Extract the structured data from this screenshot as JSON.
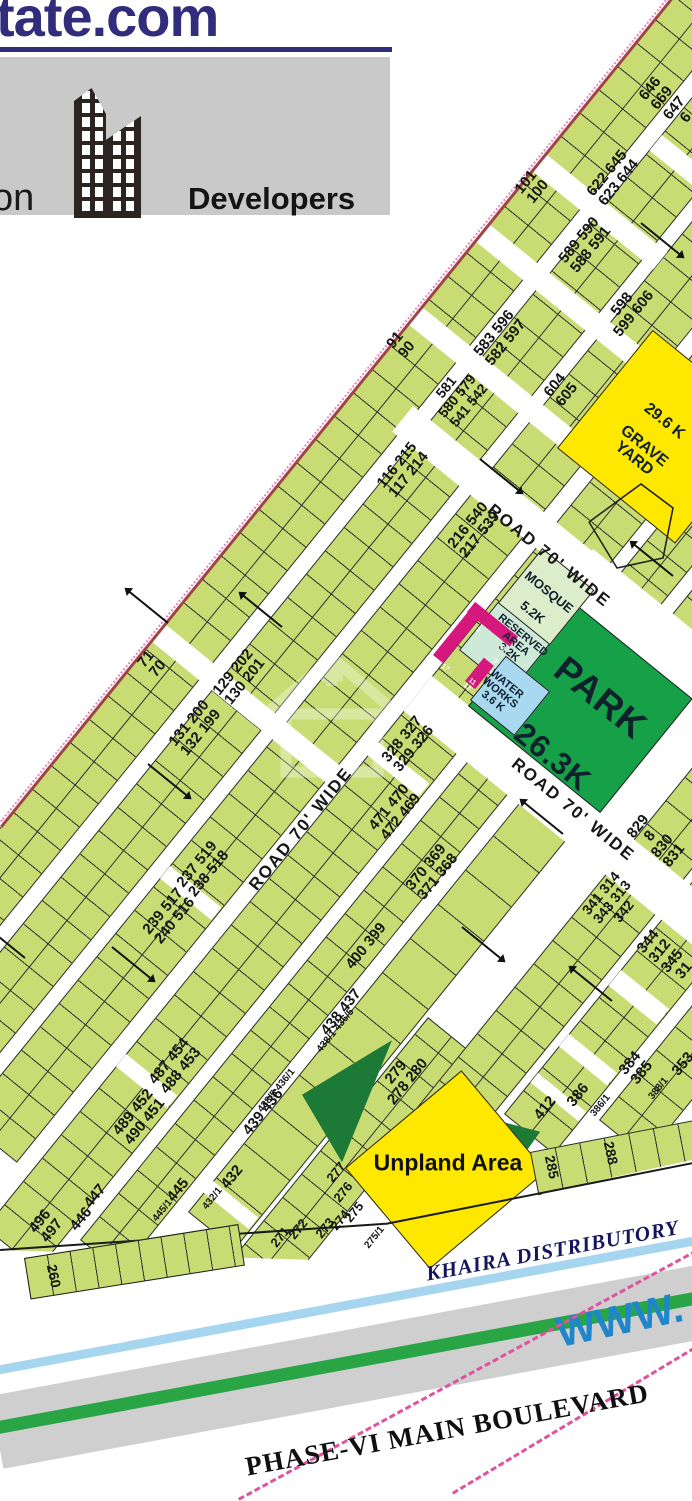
{
  "header": {
    "site_fragment": "tate.com",
    "partial_word": "on",
    "developers_label": "Developers"
  },
  "map": {
    "road_labels": [
      {
        "text": "ROAD 70' WIDE",
        "x": 549,
        "y": 556,
        "rot": 39
      },
      {
        "text": "ROAD 70' WIDE",
        "x": 301,
        "y": 829,
        "rot": -51
      },
      {
        "text": "ROAD 70' WIDE",
        "x": 573,
        "y": 810,
        "rot": 39
      }
    ],
    "areas": {
      "park": {
        "name": "PARK",
        "size": "26.3K"
      },
      "mosque": {
        "name": "MOSQUE",
        "size": "5.2K"
      },
      "reserved": {
        "name": "RESERVED AREA",
        "size": "3.2K"
      },
      "water_works": {
        "name": "WATER WORKS",
        "size": "3.6 K"
      },
      "grave_yard": {
        "size": "29.6 K",
        "name": "GRAVE YARD"
      },
      "unplanned": {
        "name": "Unpland Area"
      }
    },
    "plot_labels": [
      {
        "t": "101\n100",
        "x": 532,
        "y": 187
      },
      {
        "t": "91\n90",
        "x": 401,
        "y": 345
      },
      {
        "t": "71\n70",
        "x": 152,
        "y": 664
      },
      {
        "t": "646 669\n647 6",
        "x": 668,
        "y": 103
      },
      {
        "t": "622 645\n623 644",
        "x": 613,
        "y": 178
      },
      {
        "t": "589 590\n588 591",
        "x": 585,
        "y": 245
      },
      {
        "t": "583 596\n582 597",
        "x": 500,
        "y": 338
      },
      {
        "t": "598\n599 606",
        "x": 628,
        "y": 309
      },
      {
        "t": "604\n605",
        "x": 561,
        "y": 390
      },
      {
        "t": "581\n580 579\n541 542",
        "x": 457,
        "y": 396,
        "s": 14
      },
      {
        "t": "116 215\n117 214",
        "x": 403,
        "y": 470
      },
      {
        "t": "216 540\n217 539",
        "x": 474,
        "y": 530
      },
      {
        "t": "129 202\n130 201",
        "x": 239,
        "y": 677
      },
      {
        "t": "131 200\n132 199",
        "x": 195,
        "y": 728
      },
      {
        "t": "237 519\n238 518",
        "x": 203,
        "y": 869
      },
      {
        "t": "239 517\n240 516",
        "x": 169,
        "y": 916
      },
      {
        "t": "328 327\n329 326",
        "x": 408,
        "y": 744
      },
      {
        "t": "471 470\n472 469",
        "x": 395,
        "y": 812
      },
      {
        "t": "370 369\n371 368",
        "x": 432,
        "y": 872
      },
      {
        "t": "400 399",
        "x": 366,
        "y": 946
      },
      {
        "t": "487 454\n488 453",
        "x": 175,
        "y": 1066
      },
      {
        "t": "489 452\n490 451",
        "x": 139,
        "y": 1117
      },
      {
        "t": "438 437",
        "x": 341,
        "y": 1012
      },
      {
        "t": "438/1 436/5",
        "x": 336,
        "y": 1031,
        "s": 10
      },
      {
        "t": "438/5 436/1",
        "x": 277,
        "y": 1091,
        "s": 10
      },
      {
        "t": "439 436",
        "x": 263,
        "y": 1112
      },
      {
        "t": "445",
        "x": 178,
        "y": 1190
      },
      {
        "t": "445/1",
        "x": 163,
        "y": 1211,
        "s": 10
      },
      {
        "t": "432",
        "x": 232,
        "y": 1177
      },
      {
        "t": "432/1",
        "x": 213,
        "y": 1199,
        "s": 10
      },
      {
        "t": "447",
        "x": 95,
        "y": 1196
      },
      {
        "t": "446",
        "x": 81,
        "y": 1219
      },
      {
        "t": "496\n497",
        "x": 46,
        "y": 1226
      },
      {
        "t": "279\n278 280",
        "x": 402,
        "y": 1077
      },
      {
        "t": "277",
        "x": 336,
        "y": 1172,
        "s": 13
      },
      {
        "t": "276",
        "x": 343,
        "y": 1192,
        "s": 13
      },
      {
        "t": "275",
        "x": 354,
        "y": 1212,
        "s": 13
      },
      {
        "t": "274",
        "x": 340,
        "y": 1220,
        "s": 13
      },
      {
        "t": "273",
        "x": 325,
        "y": 1228,
        "s": 13
      },
      {
        "t": "272",
        "x": 298,
        "y": 1229,
        "s": 13
      },
      {
        "t": "271",
        "x": 280,
        "y": 1237,
        "s": 13
      },
      {
        "t": "275/1",
        "x": 375,
        "y": 1238,
        "s": 10
      },
      {
        "t": "341 314\n343 313\n342",
        "x": 612,
        "y": 902,
        "s": 14
      },
      {
        "t": "829 8\n830 831",
        "x": 656,
        "y": 841
      },
      {
        "t": "344 312\n345 31",
        "x": 666,
        "y": 956
      },
      {
        "t": "384\n385",
        "x": 636,
        "y": 1068
      },
      {
        "t": "388/1",
        "x": 659,
        "y": 1089,
        "s": 10
      },
      {
        "t": "386",
        "x": 578,
        "y": 1095
      },
      {
        "t": "386/1",
        "x": 601,
        "y": 1106,
        "s": 10
      },
      {
        "t": "412",
        "x": 545,
        "y": 1108
      },
      {
        "t": "353",
        "x": 683,
        "y": 1064
      },
      {
        "t": "285",
        "x": 552,
        "y": 1167,
        "r": 78,
        "s": 14
      },
      {
        "t": "288",
        "x": 611,
        "y": 1153,
        "r": 78,
        "s": 14
      },
      {
        "t": "260",
        "x": 54,
        "y": 1276,
        "r": 78,
        "s": 14
      }
    ],
    "water_works_plot_numbers": [
      {
        "n": "1",
        "x": 478,
        "y": 630
      },
      {
        "n": "6",
        "x": 502,
        "y": 648
      },
      {
        "n": "7",
        "x": 495,
        "y": 662
      },
      {
        "n": "17",
        "x": 445,
        "y": 668
      },
      {
        "n": "11",
        "x": 472,
        "y": 682
      },
      {
        "n": "12",
        "x": 467,
        "y": 687
      }
    ]
  },
  "bottom": {
    "khaira_label": "KHAIRA DISTRIBUTORY",
    "boulevard_label": "PHASE-VI MAIN BOULEVARD",
    "watermark_url_fragment": "WWW."
  },
  "colors": {
    "plot_green": "#c9dc73",
    "park_green": "#16a047",
    "dark_green": "#1d7a36",
    "mosque_green": "#dcedcb",
    "reserved_green": "#cfe9d8",
    "water_blue": "#a9d9f1",
    "magenta": "#d6187e",
    "yellow": "#ffe800",
    "navy": "#312c7c",
    "canal_blue": "#a6d5ef",
    "stripe_green": "#2aa545",
    "pink_dashed": "#e052a0",
    "boundary_red": "#a04545"
  }
}
